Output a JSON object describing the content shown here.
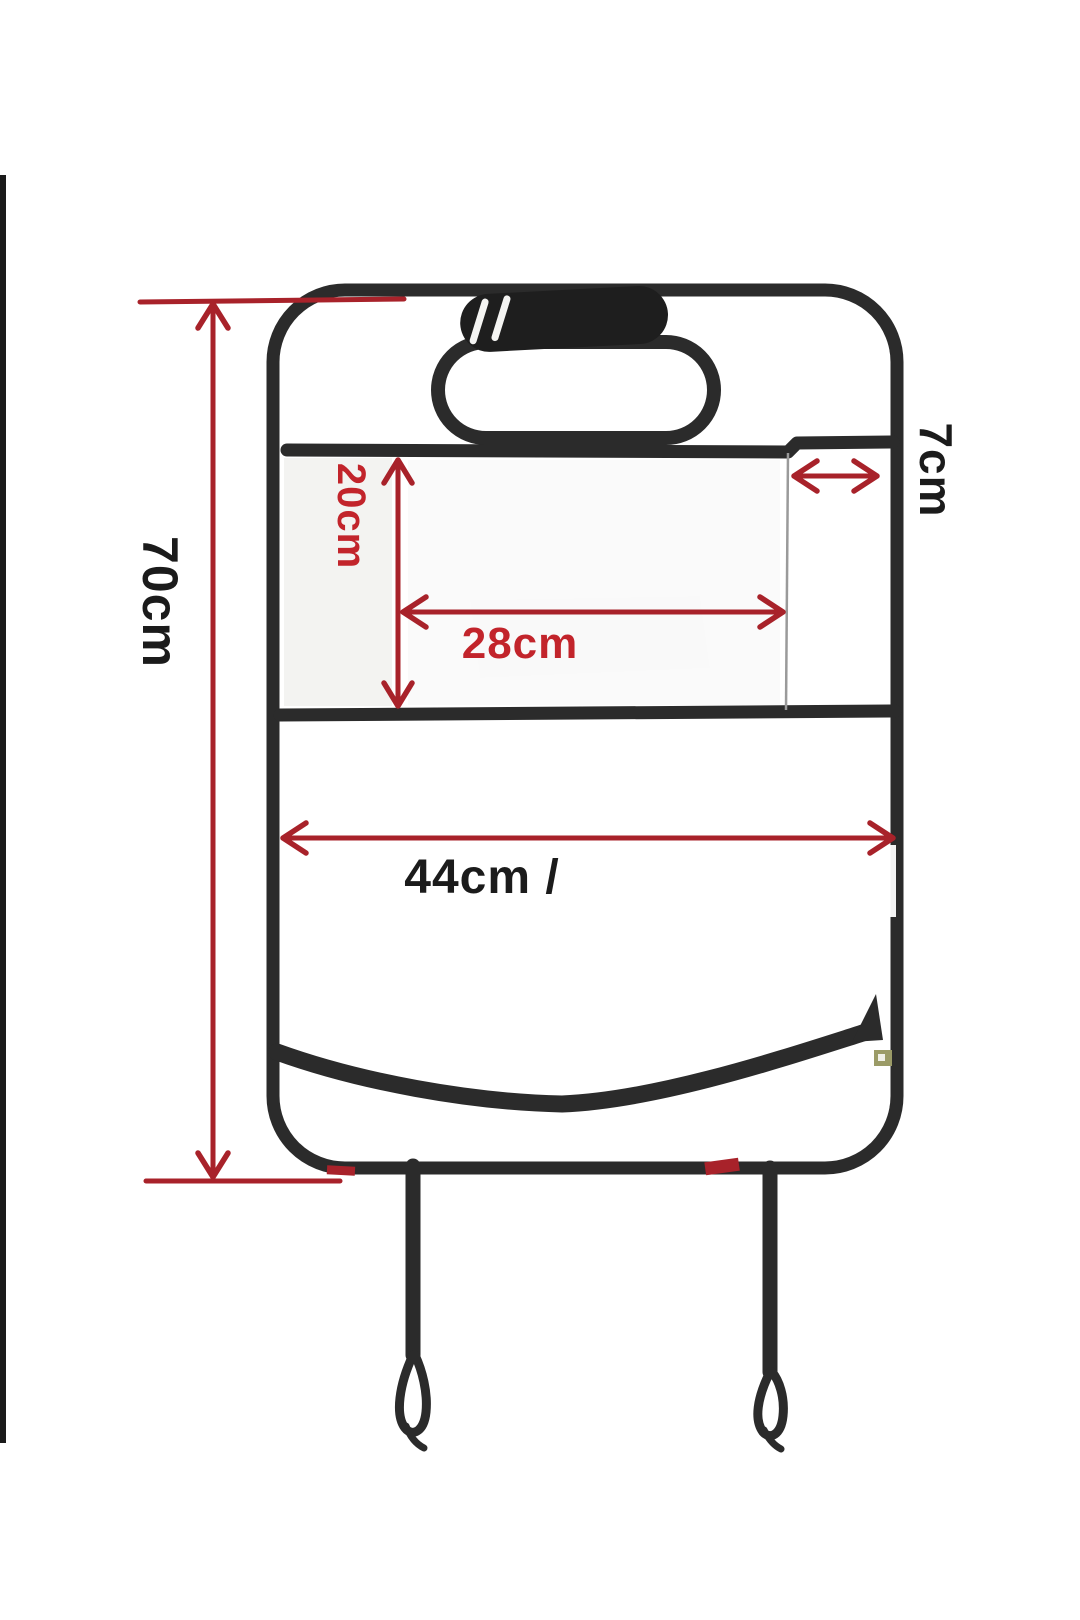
{
  "diagram": {
    "type": "product-dimension-diagram",
    "subject": "transparent car seat back protector with organizer pockets",
    "labels": {
      "height": "70cm",
      "pocket_height": "20cm",
      "pocket_width": "28cm",
      "side_pocket_width": "7cm",
      "width": "44cm /"
    }
  },
  "colors": {
    "line_red": "#a8222a",
    "text_red": "#c2242b",
    "text_black": "#1b1b1b",
    "outline_black": "#2b2b2b",
    "fabric_fill": "#f3f3f1",
    "strap_dark": "#1e1e1e",
    "zipper_gold": "#9b9b67",
    "photo_edge_black": "#1a1a1a"
  }
}
